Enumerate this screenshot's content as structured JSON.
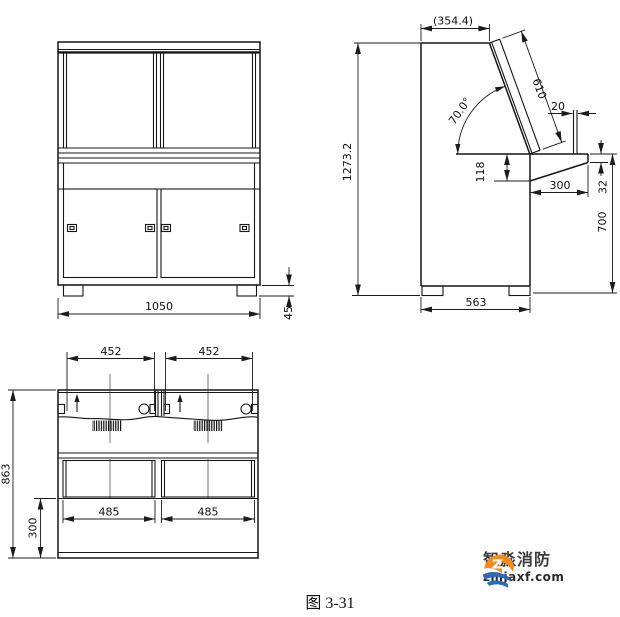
{
  "figure_caption": "图 3-31",
  "logo": {
    "name": "智淼消防",
    "domain": "zmjaxf.com"
  },
  "colors": {
    "line": "#161616",
    "logo_orange": "#f28a1e",
    "logo_blue": "#2b6cb8"
  },
  "front_view": {
    "dims": {
      "overall_width": "1050",
      "foot_height": "45"
    }
  },
  "side_view": {
    "dims": {
      "overall_height": "1273.2",
      "top_depth": "(354.4)",
      "panel_length": "610",
      "panel_angle": "70.0°",
      "ledge_width": "20",
      "under_desk_drop": "118",
      "desk_overhang": "300",
      "desk_edge_thickness": "32",
      "desk_height": "700",
      "base_depth": "563"
    }
  },
  "rear_view": {
    "dims": {
      "span_left": "452",
      "span_right": "452",
      "overall_height": "863",
      "base_height": "300",
      "door_width_left": "485",
      "door_width_right": "485"
    }
  }
}
